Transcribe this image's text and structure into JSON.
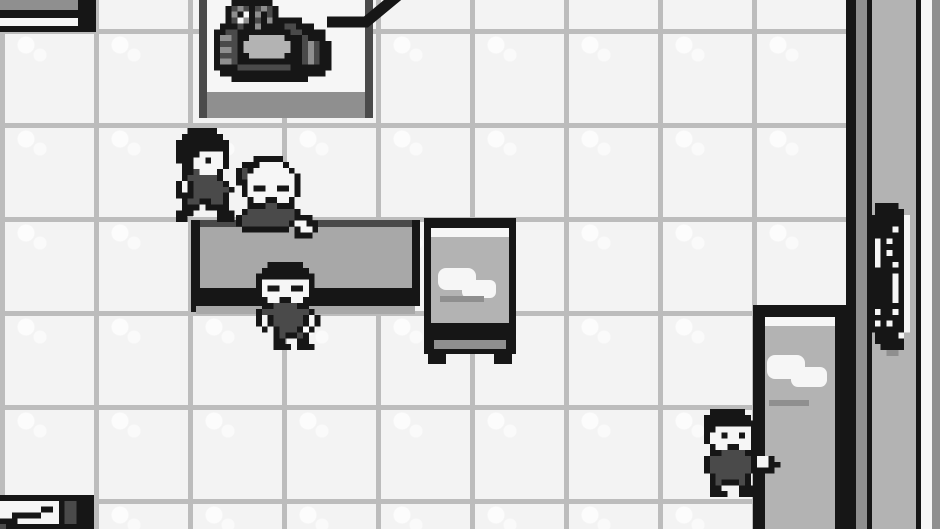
{
  "meta": {
    "title": "Game Boy RPG interior scene — tiled lab room with machine, counter, desks and four characters",
    "screen": {
      "width": 940,
      "height": 529
    }
  },
  "palette": {
    "K": "#161616",
    "D": "#4a4a4a",
    "M": "#8f8f8f",
    "L": "#b3b3b3",
    "W": "#f6f6f6",
    "counter_gray": "#a8a8a8",
    "floor": "#f3f3f3",
    "grid_line": "#bcbcbc"
  },
  "objects": {
    "floor": {
      "rect": [
        0,
        0,
        852,
        529
      ]
    },
    "bookshelf_base": {
      "rect": [
        0,
        0,
        96,
        32
      ],
      "parts": [
        [
          0,
          0,
          78,
          10,
          "M"
        ],
        [
          0,
          10,
          78,
          8,
          "K"
        ],
        [
          0,
          18,
          78,
          8,
          "W"
        ],
        [
          0,
          26,
          78,
          6,
          "K"
        ],
        [
          78,
          0,
          18,
          32,
          "K"
        ]
      ]
    },
    "machine_platform": {
      "rect": [
        199,
        0,
        174,
        118
      ],
      "parts": [
        [
          8,
          0,
          158,
          92,
          "W"
        ],
        [
          8,
          92,
          158,
          26,
          "M"
        ],
        [
          0,
          0,
          8,
          118,
          "D"
        ],
        [
          166,
          0,
          8,
          118,
          "D"
        ]
      ]
    },
    "right_wall": {
      "rect": [
        846,
        0,
        94,
        529
      ],
      "parts": [
        [
          0,
          0,
          10,
          529,
          "K"
        ],
        [
          10,
          0,
          11,
          529,
          "M"
        ],
        [
          21,
          0,
          5,
          529,
          "K"
        ],
        [
          26,
          0,
          44,
          529,
          "L"
        ],
        [
          70,
          0,
          5,
          529,
          "K"
        ],
        [
          75,
          0,
          11,
          529,
          "W"
        ],
        [
          86,
          0,
          8,
          529,
          "M"
        ]
      ]
    },
    "reception_counter": {
      "rect": [
        191,
        218,
        229,
        96
      ],
      "parts": [
        [
          0,
          2,
          9,
          92,
          "K"
        ],
        [
          9,
          2,
          212,
          7,
          "D"
        ],
        [
          9,
          9,
          212,
          61,
          "counter_gray"
        ],
        [
          221,
          2,
          8,
          68,
          "K"
        ],
        [
          0,
          70,
          229,
          18,
          "K"
        ],
        [
          5,
          88,
          219,
          8,
          "counter_gray"
        ]
      ]
    },
    "study_desk": {
      "rect": [
        424,
        216,
        92,
        148
      ],
      "parts": [
        [
          0,
          2,
          92,
          136,
          "K"
        ],
        [
          7,
          12,
          78,
          9,
          "W"
        ],
        [
          7,
          21,
          78,
          86,
          "L"
        ],
        [
          14,
          52,
          38,
          22,
          "W",
          8
        ],
        [
          38,
          64,
          34,
          18,
          "W",
          6
        ],
        [
          16,
          80,
          44,
          6,
          "M"
        ],
        [
          10,
          124,
          72,
          9,
          "M"
        ],
        [
          4,
          136,
          18,
          12,
          "K"
        ],
        [
          70,
          136,
          18,
          12,
          "K"
        ]
      ]
    },
    "side_desk": {
      "rect": [
        753,
        305,
        94,
        224
      ],
      "parts": [
        [
          0,
          0,
          94,
          224,
          "K"
        ],
        [
          12,
          12,
          70,
          212,
          "L"
        ],
        [
          12,
          12,
          70,
          9,
          "W"
        ],
        [
          14,
          50,
          38,
          24,
          "W",
          8
        ],
        [
          38,
          62,
          36,
          20,
          "W",
          7
        ],
        [
          16,
          95,
          40,
          6,
          "M"
        ]
      ]
    }
  },
  "sprites": {
    "lab_machine": {
      "rect": [
        208,
        0,
        141,
        88
      ],
      "grid": [
        "....KKKKKKK.............",
        "...KDMDKDMDK............",
        "...KMKWKMKDK............",
        "...KDWMKDKMKKKKK........",
        "..KKKDKKMKKKKDDKKK......",
        ".KKDDKKKKKKKKKDDKKKK....",
        ".KMMDKKLLLLLLKKKDKKK....",
        ".KDDDKLLLLLLLLKKDMDKK...",
        ".KMMDKLLLLLLLLKKDMDKK...",
        ".KDDDKKLLLLLLKKKDMDKK...",
        ".KMMDKKKKKKKKKKKDMDKK...",
        ".KKKKDDDDDDDDDKKKKKKK...",
        "..KKKKKKKKKKKKKKKKKK....",
        "....KKKKKKKKKKKKK.......",
        "........................"
      ]
    },
    "wall_console": {
      "rect": [
        863,
        203,
        53,
        153
      ],
      "grid": [
        "..KKKK...",
        "..KKKKK..",
        ".KKKKKKW.",
        ".KKKKKKW.",
        ".KKKKWKW.",
        ".KKKKKKW.",
        ".KWKWKKW.",
        ".KWKKKKW.",
        ".KWKWKKW.",
        ".KWKKKKW.",
        ".KWKKWKW.",
        ".KKKKKKW.",
        ".KKKKWKW.",
        ".KKKKWKW.",
        ".KKKKWKW.",
        ".KKKKWKW.",
        ".KKKKWKW.",
        ".KKKKKKW.",
        ".KWKKWKW.",
        ".KKKKKKW.",
        ".KWKWKKW.",
        ".KKKKKKW.",
        "..KKKKW..",
        "..KKKKK..",
        "...KKKK..",
        "....MM..."
      ]
    },
    "npc_trainer": {
      "rect": [
        170,
        128,
        94,
        94
      ],
      "grid": [
        "...KKKKK........",
        "..KKKKKKK.......",
        ".KKKKKKKKK......",
        ".KKKKKKKKK......",
        ".KKKKWWWWK......",
        ".KKKWWKWWK......",
        "..KKWWWWWK......",
        "..KKDWWWK.......",
        "..KDDDDDK.......",
        ".KWKDDDDDK......",
        ".KWKDDDDDDK.....",
        ".KKKDDDDDK......",
        "..KDDKKDDK......",
        "..KKK.KKKK......",
        ".KKK....KKK.....",
        ".KK.....KKK....."
      ]
    },
    "npc_oldman": {
      "rect": [
        230,
        156,
        94,
        94
      ],
      "grid": [
        "....KKKKK.......",
        "..KKKWWWWK......",
        ".KDKWWWWWWK.....",
        ".KDWWWWWWWWK....",
        ".KKWWWWWWWWK....",
        "..KWKKWWKKWK....",
        "..KWWWWWWWWK....",
        "...KWWKKWWK.....",
        "...KKKDDKKK.....",
        "..KDDDDDDDDK....",
        ".KDDDDDDDDDKKK..",
        ".KDDDDDDDDKWWKK.",
        "..KKKKKKKK.KWWK.",
        "...........KKK..",
        "................",
        "................"
      ]
    },
    "npc_boy": {
      "rect": [
        250,
        256,
        94,
        94
      ],
      "grid": [
        "................",
        "...KKKKKK.......",
        "..KKKKKKKK......",
        ".KKKKKKKKKK.....",
        ".KWWWWWWWWK.....",
        ".KWKKWWKKWK.....",
        ".KWWWWWWWWK.....",
        "..KWWKKWWK......",
        "..KKDDDDKK......",
        ".KDDDDDDDDK.....",
        ".KWKDDDDDKWK....",
        ".KWKDDDDDKWK....",
        "..K.KDDDK.K.....",
        "....KDKKDK......",
        "....KK..KK......",
        "....KKK.KKK....."
      ]
    },
    "npc_kid": {
      "rect": [
        698,
        403,
        94,
        94
      ],
      "grid": [
        "................",
        "..KKKKKK........",
        ".KKKKKKKK.......",
        ".KKKKKKKKK......",
        ".KKWWWWWWK......",
        ".KWWKWWKWK......",
        ".KWWWWWWWK......",
        "..KWWKKWWK......",
        "..KKDDDDKK......",
        ".KDDDDDDDKWWK...",
        ".KDDDDDDDKWWKK..",
        ".KDDDDDDDKKKK...",
        "..KDDDDDK.......",
        "..KDKKKDK.......",
        "..KK...KKK......",
        "..KKK..KKK......"
      ]
    },
    "corner_machine": {
      "rect": [
        0,
        495,
        94,
        35
      ],
      "grid": [
        "KKKKKKKKKKKKKKKK",
        "WWWWWWWWWWKDDKKK",
        "WWWWWWWKKWKDDKKK",
        "WWKKKKKWWWKDDKKK",
        "KKKWWWWWWWKDDKKK",
        "DKKKKKKKKKKKKKKK"
      ]
    }
  },
  "cable": {
    "rect": [
      315,
      0,
      96,
      36
    ],
    "bar_from_x": 12,
    "bar_to_x": 51,
    "bar_y": 22,
    "diag_to_x": 86,
    "diag_to_y": -7,
    "thickness": 11
  }
}
